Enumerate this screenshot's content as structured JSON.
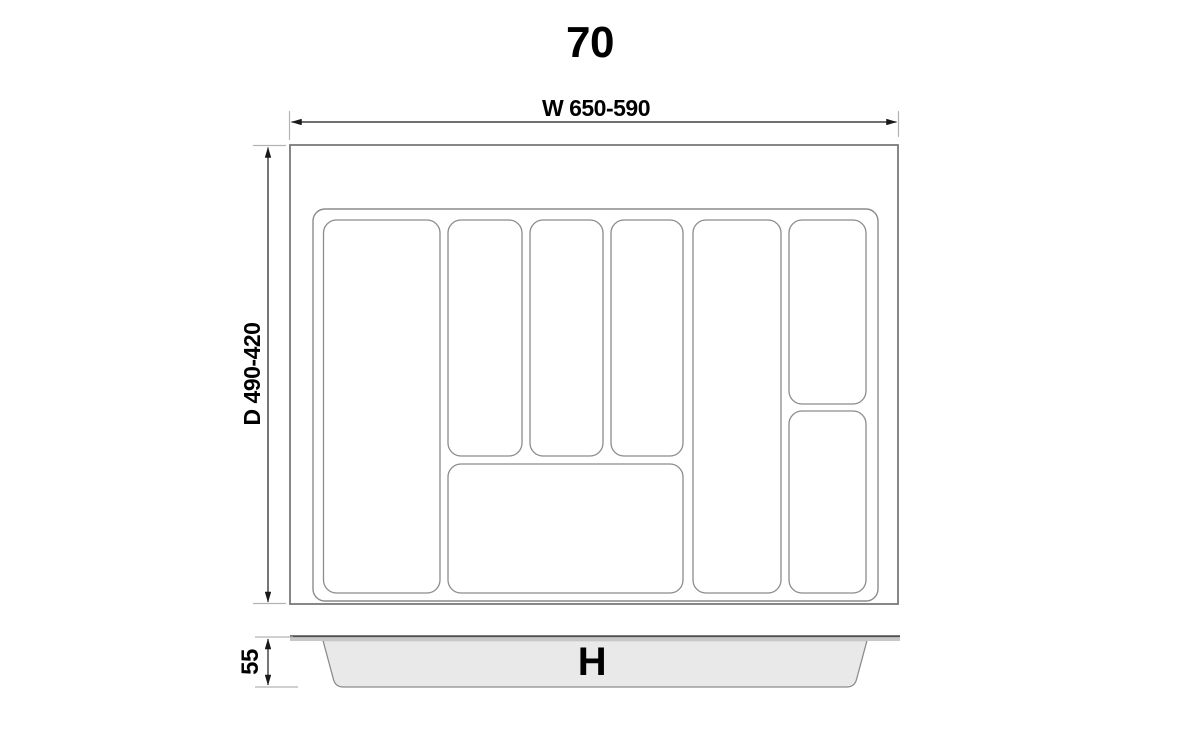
{
  "title": "70",
  "top_view": {
    "width_dimension_label": "W 650-590",
    "depth_dimension_label": "D 490-420",
    "compartment_count": 8
  },
  "side_view": {
    "height_dimension_label": "55",
    "height_label": "H"
  },
  "colors": {
    "dimension_line": "#1a1a1a",
    "extension_line": "#b3b3b3",
    "outer_frame": "#7a7a7a",
    "outline": "#8c8c8c",
    "tray_fill": "#e9e9e9",
    "rim_fill": "#c7c7c7",
    "rim_edge": "#4f4f4f",
    "text": "#000000",
    "background": "#ffffff"
  }
}
